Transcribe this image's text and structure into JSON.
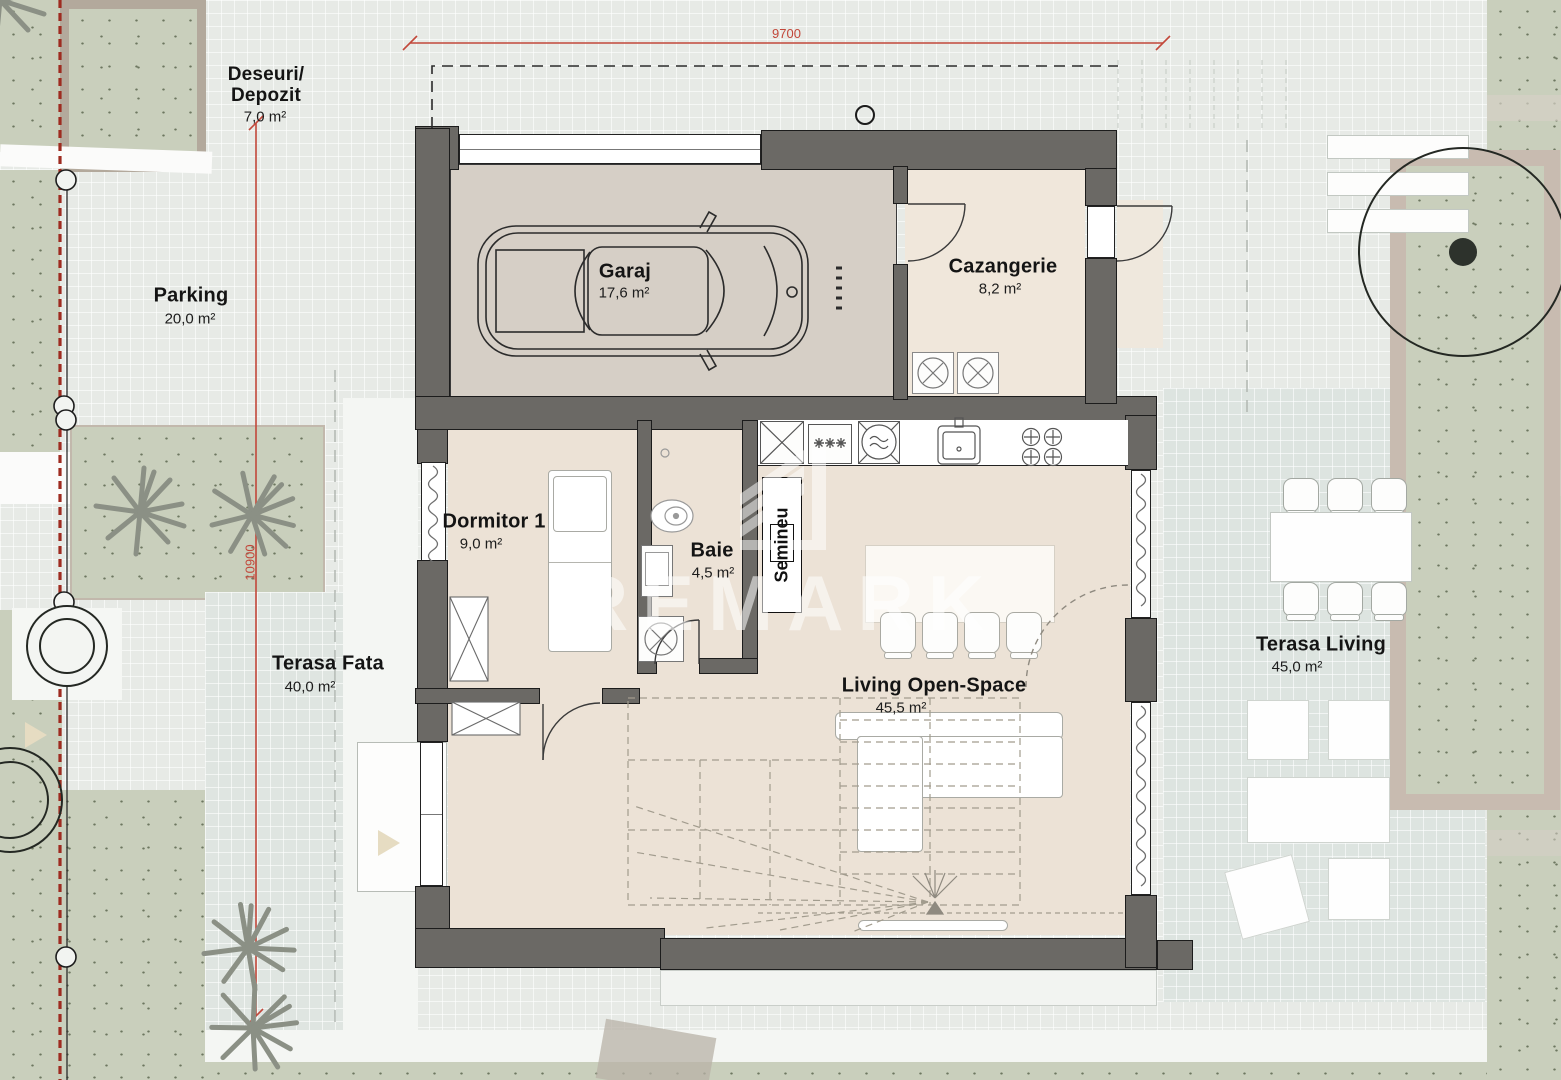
{
  "rooms": {
    "garaj": {
      "name": "Garaj",
      "area": "17,6 m²"
    },
    "cazangerie": {
      "name": "Cazangerie",
      "area": "8,2 m²"
    },
    "dormitor1": {
      "name": "Dormitor 1",
      "area": "9,0 m²"
    },
    "baie": {
      "name": "Baie",
      "area": "4,5 m²"
    },
    "living": {
      "name": "Living Open-Space",
      "area": "45,5 m²"
    },
    "semineu": {
      "name": "Semineu"
    }
  },
  "outdoor": {
    "deseuri": {
      "line1": "Deseuri/",
      "line2": "Depozit",
      "area": "7,0 m²"
    },
    "parking": {
      "name": "Parking",
      "area": "20,0 m²"
    },
    "terasa_fata": {
      "name": "Terasa Fata",
      "area": "40,0 m²"
    },
    "terasa_living": {
      "name": "Terasa Living",
      "area": "45,0 m²"
    }
  },
  "dimensions": {
    "width_mm": "9700",
    "height_mm": "10900"
  },
  "watermark": {
    "text": "REMARK"
  },
  "colors": {
    "dimension_red": "#c2473a",
    "boundary_red": "#9e2b20",
    "wall_gray": "#6b6965",
    "floor_cream": "#ece2d6",
    "garage_floor": "#d6cfc6",
    "terrace_gray": "#dfe5e1",
    "vegetation_green": "#c9cfbc"
  }
}
